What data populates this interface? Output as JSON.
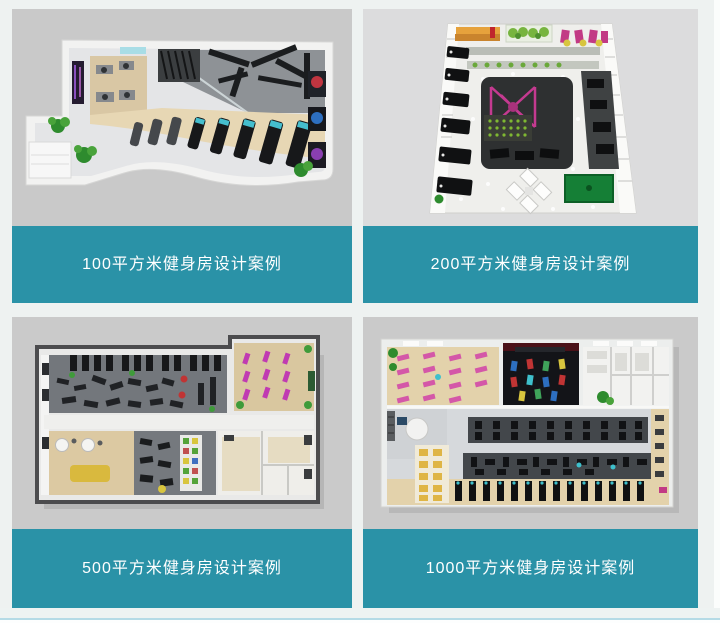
{
  "page": {
    "background_color": "#eef2f1",
    "accent_color": "#2a92a7",
    "caption_text_color": "#ffffff",
    "card_image_background": "#c9c9c9",
    "bottom_divider_color": "#b5dbe6"
  },
  "cards": [
    {
      "area_sqm": 100,
      "caption": "100平方米健身房设计案例",
      "image_name": "gym-floorplan-100sqm-render"
    },
    {
      "area_sqm": 200,
      "caption": "200平方米健身房设计案例",
      "image_name": "gym-floorplan-200sqm-render"
    },
    {
      "area_sqm": 500,
      "caption": "500平方米健身房设计案例",
      "image_name": "gym-floorplan-500sqm-render"
    },
    {
      "area_sqm": 1000,
      "caption": "1000平方米健身房设计案例",
      "image_name": "gym-floorplan-1000sqm-render"
    }
  ]
}
